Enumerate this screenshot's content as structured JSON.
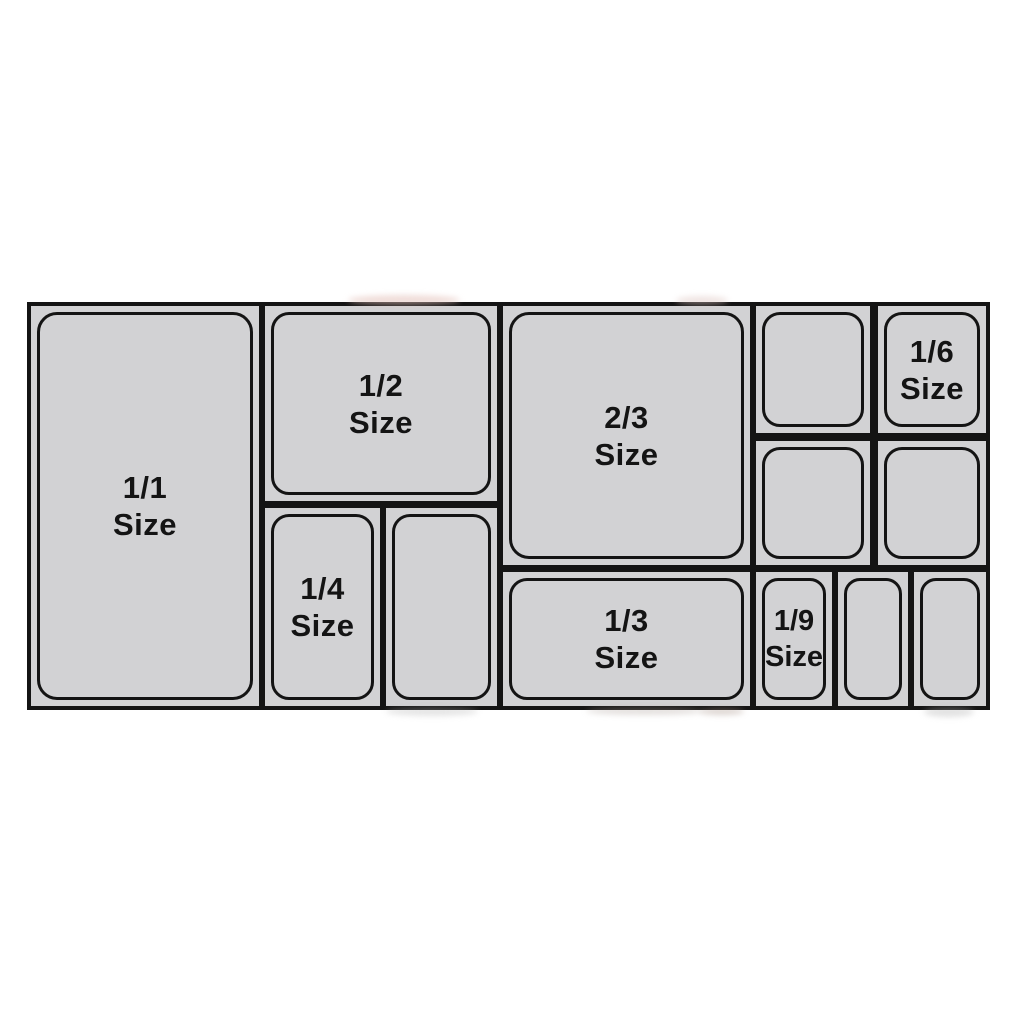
{
  "pans": [
    {
      "id": "1-1",
      "fraction": "1/1",
      "size_word": "Size"
    },
    {
      "id": "1-2",
      "fraction": "1/2",
      "size_word": "Size"
    },
    {
      "id": "1-4",
      "fraction": "1/4",
      "size_word": "Size"
    },
    {
      "id": "quarter-unlabeled",
      "fraction": "",
      "size_word": ""
    },
    {
      "id": "2-3",
      "fraction": "2/3",
      "size_word": "Size"
    },
    {
      "id": "1-3",
      "fraction": "1/3",
      "size_word": "Size"
    },
    {
      "id": "sixth-unlabeled-a",
      "fraction": "",
      "size_word": ""
    },
    {
      "id": "1-6",
      "fraction": "1/6",
      "size_word": "Size"
    },
    {
      "id": "sixth-unlabeled-b",
      "fraction": "",
      "size_word": ""
    },
    {
      "id": "sixth-unlabeled-c",
      "fraction": "",
      "size_word": ""
    },
    {
      "id": "1-9",
      "fraction": "1/9",
      "size_word": "Size"
    },
    {
      "id": "ninth-unlabeled-a",
      "fraction": "",
      "size_word": ""
    },
    {
      "id": "ninth-unlabeled-b",
      "fraction": "",
      "size_word": ""
    }
  ],
  "colors": {
    "pan_fill": "#d2d2d4",
    "outline": "#141414",
    "background": "#ffffff"
  }
}
